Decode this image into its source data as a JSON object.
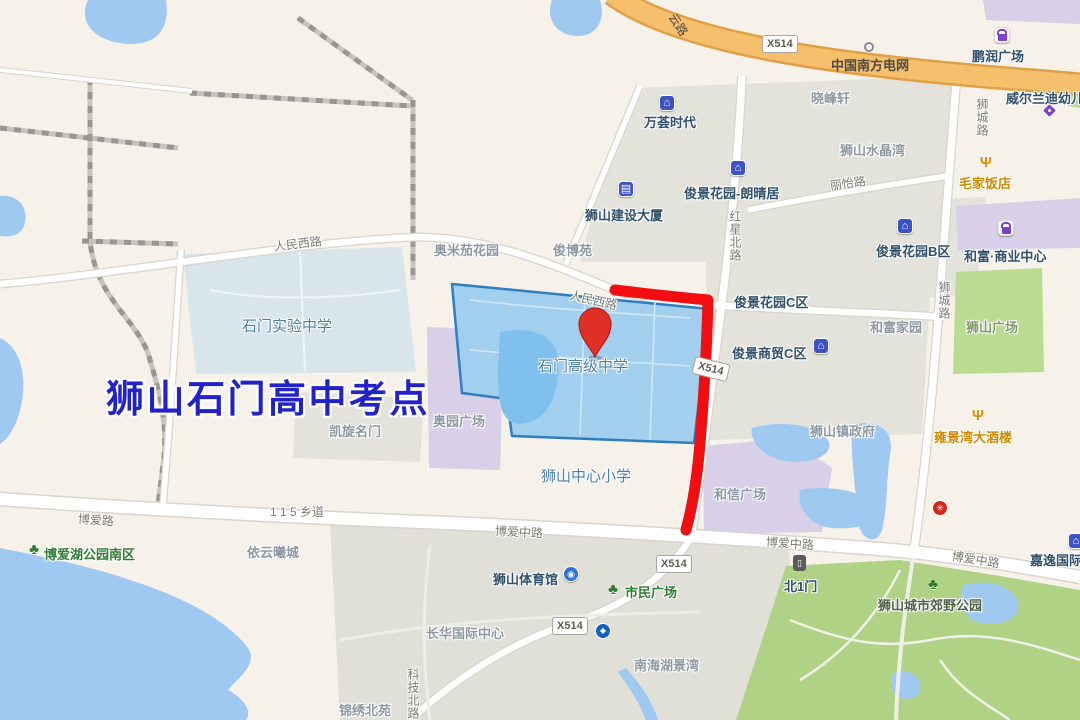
{
  "map_title": "狮山石门高中考点",
  "pin_label": "石门高级中学",
  "colors": {
    "land": "#F7F2E9",
    "block_gray": "#E3E2DB",
    "water": "#9FC9F0",
    "park_green": "#AFD285",
    "plaza_green": "#B9DB92",
    "purple_area": "#D8CFE9",
    "campus_pale": "#D8E5EB",
    "school_fill": "#A3CFEE",
    "school_border": "#2E7EC0",
    "highway_orange": "#F5BF6B",
    "route_red": "#F20D11",
    "pin_red": "#E02F24",
    "title_blue": "#2222CB"
  },
  "icon_glyphs": {
    "house": "⌂",
    "building": "▤",
    "fork": "Ψ",
    "tree": "♣",
    "stadium": "◉",
    "bank": "◆",
    "door": "▯",
    "redbadge": "✳",
    "bag": "",
    "tag": "",
    "circle": ""
  },
  "badges": [
    {
      "name": "badge-x514-highway",
      "text": "X514",
      "x": 762,
      "y": 35,
      "rot": 0
    },
    {
      "name": "badge-x514-mid",
      "text": "X514",
      "x": 693,
      "y": 360,
      "rot": 14
    },
    {
      "name": "badge-x514-boai",
      "text": "X514",
      "x": 656,
      "y": 555,
      "rot": 0
    },
    {
      "name": "badge-x514-southwest",
      "text": "X514",
      "x": 552,
      "y": 617,
      "rot": 0
    }
  ],
  "icons": [
    {
      "name": "wanhui-house-icon",
      "type": "house",
      "x": 659,
      "y": 95,
      "inter": true
    },
    {
      "name": "pengrun-bag-icon",
      "type": "bag",
      "x": 994,
      "y": 27,
      "inter": true
    },
    {
      "name": "price-tag-icon",
      "type": "tag",
      "x": 1044,
      "y": 105,
      "inter": true
    },
    {
      "name": "maojia-fork-icon",
      "type": "fork",
      "x": 978,
      "y": 154,
      "inter": true
    },
    {
      "name": "langqingju-house-icon",
      "type": "house",
      "x": 730,
      "y": 160,
      "inter": true
    },
    {
      "name": "jianshe-building-icon",
      "type": "building",
      "x": 618,
      "y": 181,
      "inter": true
    },
    {
      "name": "junjing-b-house-icon",
      "type": "house",
      "x": 897,
      "y": 218,
      "inter": true
    },
    {
      "name": "hefu-bag-icon",
      "type": "bag",
      "x": 998,
      "y": 220,
      "inter": true
    },
    {
      "name": "shangmao-c-house-icon",
      "type": "house",
      "x": 813,
      "y": 338,
      "inter": true
    },
    {
      "name": "yongjingwan-fork-icon",
      "type": "fork",
      "x": 970,
      "y": 407,
      "inter": true
    },
    {
      "name": "power-grid-node-icon",
      "type": "circle",
      "x": 864,
      "y": 42,
      "inter": false
    },
    {
      "name": "boaihu-tree-icon",
      "type": "tree",
      "x": 26,
      "y": 541,
      "inter": true
    },
    {
      "name": "shimin-tree-icon",
      "type": "tree",
      "x": 605,
      "y": 581,
      "inter": true
    },
    {
      "name": "gym-stadium-icon",
      "type": "stadium",
      "x": 563,
      "y": 566,
      "inter": true
    },
    {
      "name": "bank-icon",
      "type": "bank",
      "x": 595,
      "y": 623,
      "inter": true
    },
    {
      "name": "north-gate-door-icon",
      "type": "door",
      "x": 793,
      "y": 555,
      "inter": true
    },
    {
      "name": "red-poi-badge-icon",
      "type": "redbadge",
      "x": 932,
      "y": 500,
      "inter": true
    },
    {
      "name": "park-tree-icon",
      "type": "tree",
      "x": 925,
      "y": 576,
      "inter": true
    },
    {
      "name": "jiayi-house-icon",
      "type": "house",
      "x": 1068,
      "y": 533,
      "inter": true
    }
  ],
  "labels": [
    {
      "name": "road-label-yunlu",
      "text": "云路",
      "cls": "road onroad",
      "x": 672,
      "y": 6,
      "rot": 57
    },
    {
      "name": "poi-china-southern-power-grid",
      "text": "中国南方电网",
      "cls": "onroad",
      "x": 831,
      "y": 55,
      "inter": true
    },
    {
      "name": "poi-pengrun-plaza",
      "text": "鹏润广场",
      "cls": "",
      "x": 972,
      "y": 46,
      "inter": true
    },
    {
      "name": "poi-weierlandi-kindergarten",
      "text": "威尔兰迪幼儿园",
      "cls": "",
      "x": 1006,
      "y": 88,
      "inter": true
    },
    {
      "name": "area-xiaofengxuan",
      "text": "晓峰轩",
      "cls": "area",
      "x": 811,
      "y": 88
    },
    {
      "name": "poi-wanhui-times",
      "text": "万荟时代",
      "cls": "",
      "x": 644,
      "y": 112,
      "inter": true
    },
    {
      "name": "area-shishan-crystal-bay",
      "text": "狮山水晶湾",
      "cls": "area",
      "x": 840,
      "y": 140
    },
    {
      "name": "poi-maojia-restaurant",
      "text": "毛家饭店",
      "cls": "orange",
      "x": 959,
      "y": 173,
      "inter": true
    },
    {
      "name": "road-shicheng-road-north",
      "text": "狮城路",
      "cls": "road vert",
      "x": 974,
      "y": 98
    },
    {
      "name": "poi-junjing-langqingju",
      "text": "俊景花园-朗晴居",
      "cls": "",
      "x": 684,
      "y": 183,
      "inter": true
    },
    {
      "name": "road-liyi-road",
      "text": "丽怡路",
      "cls": "road",
      "x": 830,
      "y": 177,
      "rot": -8
    },
    {
      "name": "poi-shishan-jianshe-building",
      "text": "狮山建设大厦",
      "cls": "",
      "x": 585,
      "y": 205,
      "inter": true
    },
    {
      "name": "area-aomijia-garden",
      "text": "奥米茄花园",
      "cls": "area",
      "x": 434,
      "y": 240
    },
    {
      "name": "area-junboyuan",
      "text": "俊博苑",
      "cls": "area",
      "x": 553,
      "y": 240
    },
    {
      "name": "road-renmin-west-road-1",
      "text": "人民西路",
      "cls": "road",
      "x": 274,
      "y": 238,
      "rot": -7
    },
    {
      "name": "road-renmin-west-road-2",
      "text": "人民西路",
      "cls": "road",
      "x": 570,
      "y": 286,
      "rot": 13
    },
    {
      "name": "road-hongxing-north-road",
      "text": "红星北路",
      "cls": "road vert",
      "x": 727,
      "y": 210
    },
    {
      "name": "poi-junjing-garden-c",
      "text": "俊景花园C区",
      "cls": "",
      "x": 734,
      "y": 292,
      "inter": true
    },
    {
      "name": "poi-junjing-garden-b",
      "text": "俊景花园B区",
      "cls": "",
      "x": 876,
      "y": 241,
      "inter": true
    },
    {
      "name": "poi-hefu-business-center",
      "text": "和富·商业中心",
      "cls": "",
      "x": 964,
      "y": 246,
      "inter": true
    },
    {
      "name": "area-hefu-jiayuan",
      "text": "和富家园",
      "cls": "area",
      "x": 870,
      "y": 317
    },
    {
      "name": "area-shishan-plaza",
      "text": "狮山广场",
      "cls": "area-green",
      "x": 966,
      "y": 317
    },
    {
      "name": "poi-junjing-shangmao-c",
      "text": "俊景商贸C区",
      "cls": "",
      "x": 732,
      "y": 343,
      "inter": true
    },
    {
      "name": "campus-shimen-experimental",
      "text": "石门实验中学",
      "cls": "campus",
      "x": 242,
      "y": 315
    },
    {
      "name": "campus-shimen-senior-high",
      "text": "石门高级中学",
      "cls": "campus",
      "x": 538,
      "y": 355,
      "inter": true
    },
    {
      "name": "title-exam-site",
      "text": "狮山石门高中考点",
      "cls": "title",
      "x": 106,
      "y": 368
    },
    {
      "name": "area-aoyuan-plaza",
      "text": "奥园广场",
      "cls": "area",
      "x": 433,
      "y": 411
    },
    {
      "name": "area-kaixuan-mingmen",
      "text": "凯旋名门",
      "cls": "area",
      "x": 329,
      "y": 421
    },
    {
      "name": "campus-shishan-central-primary",
      "text": "狮山中心小学",
      "cls": "campus",
      "x": 541,
      "y": 465
    },
    {
      "name": "area-shishan-town-gov",
      "text": "狮山镇政府",
      "cls": "area",
      "x": 810,
      "y": 421
    },
    {
      "name": "poi-yongjingwan-restaurant",
      "text": "雍景湾大酒楼",
      "cls": "orange",
      "x": 934,
      "y": 427,
      "inter": true
    },
    {
      "name": "area-hexin-plaza",
      "text": "和信广场",
      "cls": "area",
      "x": 714,
      "y": 484
    },
    {
      "name": "road-boai-road",
      "text": "博爱路",
      "cls": "road",
      "x": 78,
      "y": 510,
      "rot": 4
    },
    {
      "name": "road-115-township",
      "text": "1 1 5 乡道",
      "cls": "road",
      "x": 270,
      "y": 503
    },
    {
      "name": "road-boai-middle-road-1",
      "text": "博爱中路",
      "cls": "road",
      "x": 495,
      "y": 522,
      "rot": 3
    },
    {
      "name": "road-boai-middle-road-2",
      "text": "博爱中路",
      "cls": "road",
      "x": 766,
      "y": 533,
      "rot": 4
    },
    {
      "name": "road-boai-middle-road-3",
      "text": "博爱中路",
      "cls": "road",
      "x": 952,
      "y": 547,
      "rot": 9
    },
    {
      "name": "poi-jiayi-international",
      "text": "嘉逸国际",
      "cls": "",
      "x": 1030,
      "y": 550,
      "inter": true
    },
    {
      "name": "poi-north-gate-1",
      "text": "北1门",
      "cls": "",
      "x": 784,
      "y": 576,
      "inter": true
    },
    {
      "name": "poi-shishan-country-park",
      "text": "狮山城市郊野公园",
      "cls": "park",
      "x": 878,
      "y": 595,
      "inter": true
    },
    {
      "name": "poi-boaihu-park-south",
      "text": "博爱湖公园南区",
      "cls": "green",
      "x": 44,
      "y": 544,
      "inter": true
    },
    {
      "name": "area-yiyun-xicheng",
      "text": "依云曦城",
      "cls": "area",
      "x": 247,
      "y": 542
    },
    {
      "name": "poi-shishan-gym",
      "text": "狮山体育馆",
      "cls": "",
      "x": 493,
      "y": 569,
      "inter": true
    },
    {
      "name": "poi-citizen-plaza",
      "text": "市民广场",
      "cls": "green",
      "x": 625,
      "y": 582,
      "inter": true
    },
    {
      "name": "area-changhua-intl-center",
      "text": "长华国际中心",
      "cls": "area",
      "x": 426,
      "y": 623
    },
    {
      "name": "area-nanhai-lakeview",
      "text": "南海湖景湾",
      "cls": "area",
      "x": 634,
      "y": 655
    },
    {
      "name": "area-jinxiu-beiyuan",
      "text": "锦绣北苑",
      "cls": "area",
      "x": 339,
      "y": 700
    },
    {
      "name": "road-keji-north-road",
      "text": "科技北路",
      "cls": "road vert",
      "x": 405,
      "y": 668
    },
    {
      "name": "road-shicheng-road-south",
      "text": "狮城路",
      "cls": "road vert",
      "x": 936,
      "y": 281
    }
  ]
}
